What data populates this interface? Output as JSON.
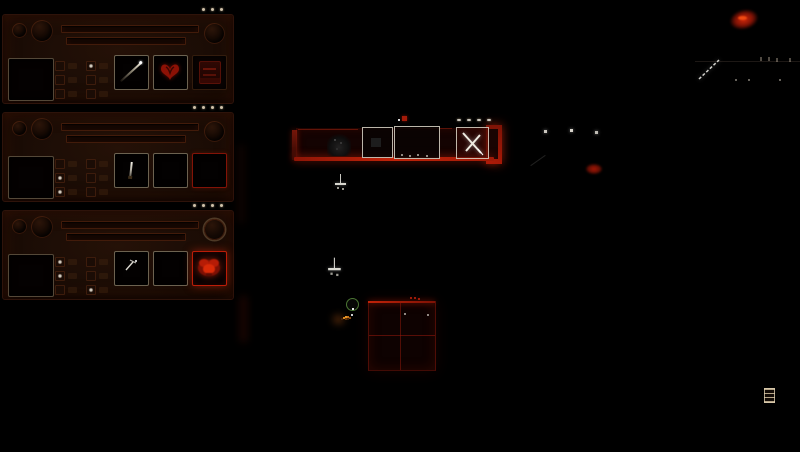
{
  "app": {
    "name": "dungeon-mining-game-hud"
  },
  "theme": {
    "background": "#000000",
    "panel_bg": "#1d0d06",
    "panel_border": "#2e130a",
    "slot_border": "#d6c4a0",
    "accent_red": "#b01a08",
    "bright_red": "#e02408",
    "glow_red": "#c12309",
    "pip_color": "#cfc0a9",
    "white": "#eeeae0",
    "green": "#84d25a",
    "orange": "#e89b2a"
  },
  "sidebar": {
    "panels": [
      {
        "id": "unit-1",
        "pips": 3,
        "lit_stats": [
          1
        ],
        "slots": [
          {
            "icon": "spear-icon"
          },
          {
            "icon": "wing-emblem-icon"
          },
          {
            "icon": "furnace-icon"
          }
        ]
      },
      {
        "id": "unit-2",
        "pips": 4,
        "lit_stats": [
          2,
          4
        ],
        "slots": [
          {
            "icon": "knife-icon"
          },
          {
            "icon": "empty-slot"
          },
          {
            "icon": "empty-slot"
          }
        ]
      },
      {
        "id": "unit-3",
        "pips": 4,
        "lit_stats": [
          0,
          2,
          5
        ],
        "slots": [
          {
            "icon": "pick-icon"
          },
          {
            "icon": "empty-slot"
          },
          {
            "icon": "crab-emblem-icon"
          }
        ]
      }
    ]
  },
  "world": {
    "crate_pips": 4,
    "grid": {
      "rows": 2,
      "cols": 2
    },
    "objects": [
      "supply-platform",
      "crate-plain",
      "crate-wide",
      "crate-crossed",
      "flag-marker",
      "hanging-sprite",
      "miner-group",
      "frame-structure",
      "lantern-dots",
      "ember-glow",
      "ceiling-glow",
      "rope-arrow",
      "ladder-item"
    ]
  }
}
